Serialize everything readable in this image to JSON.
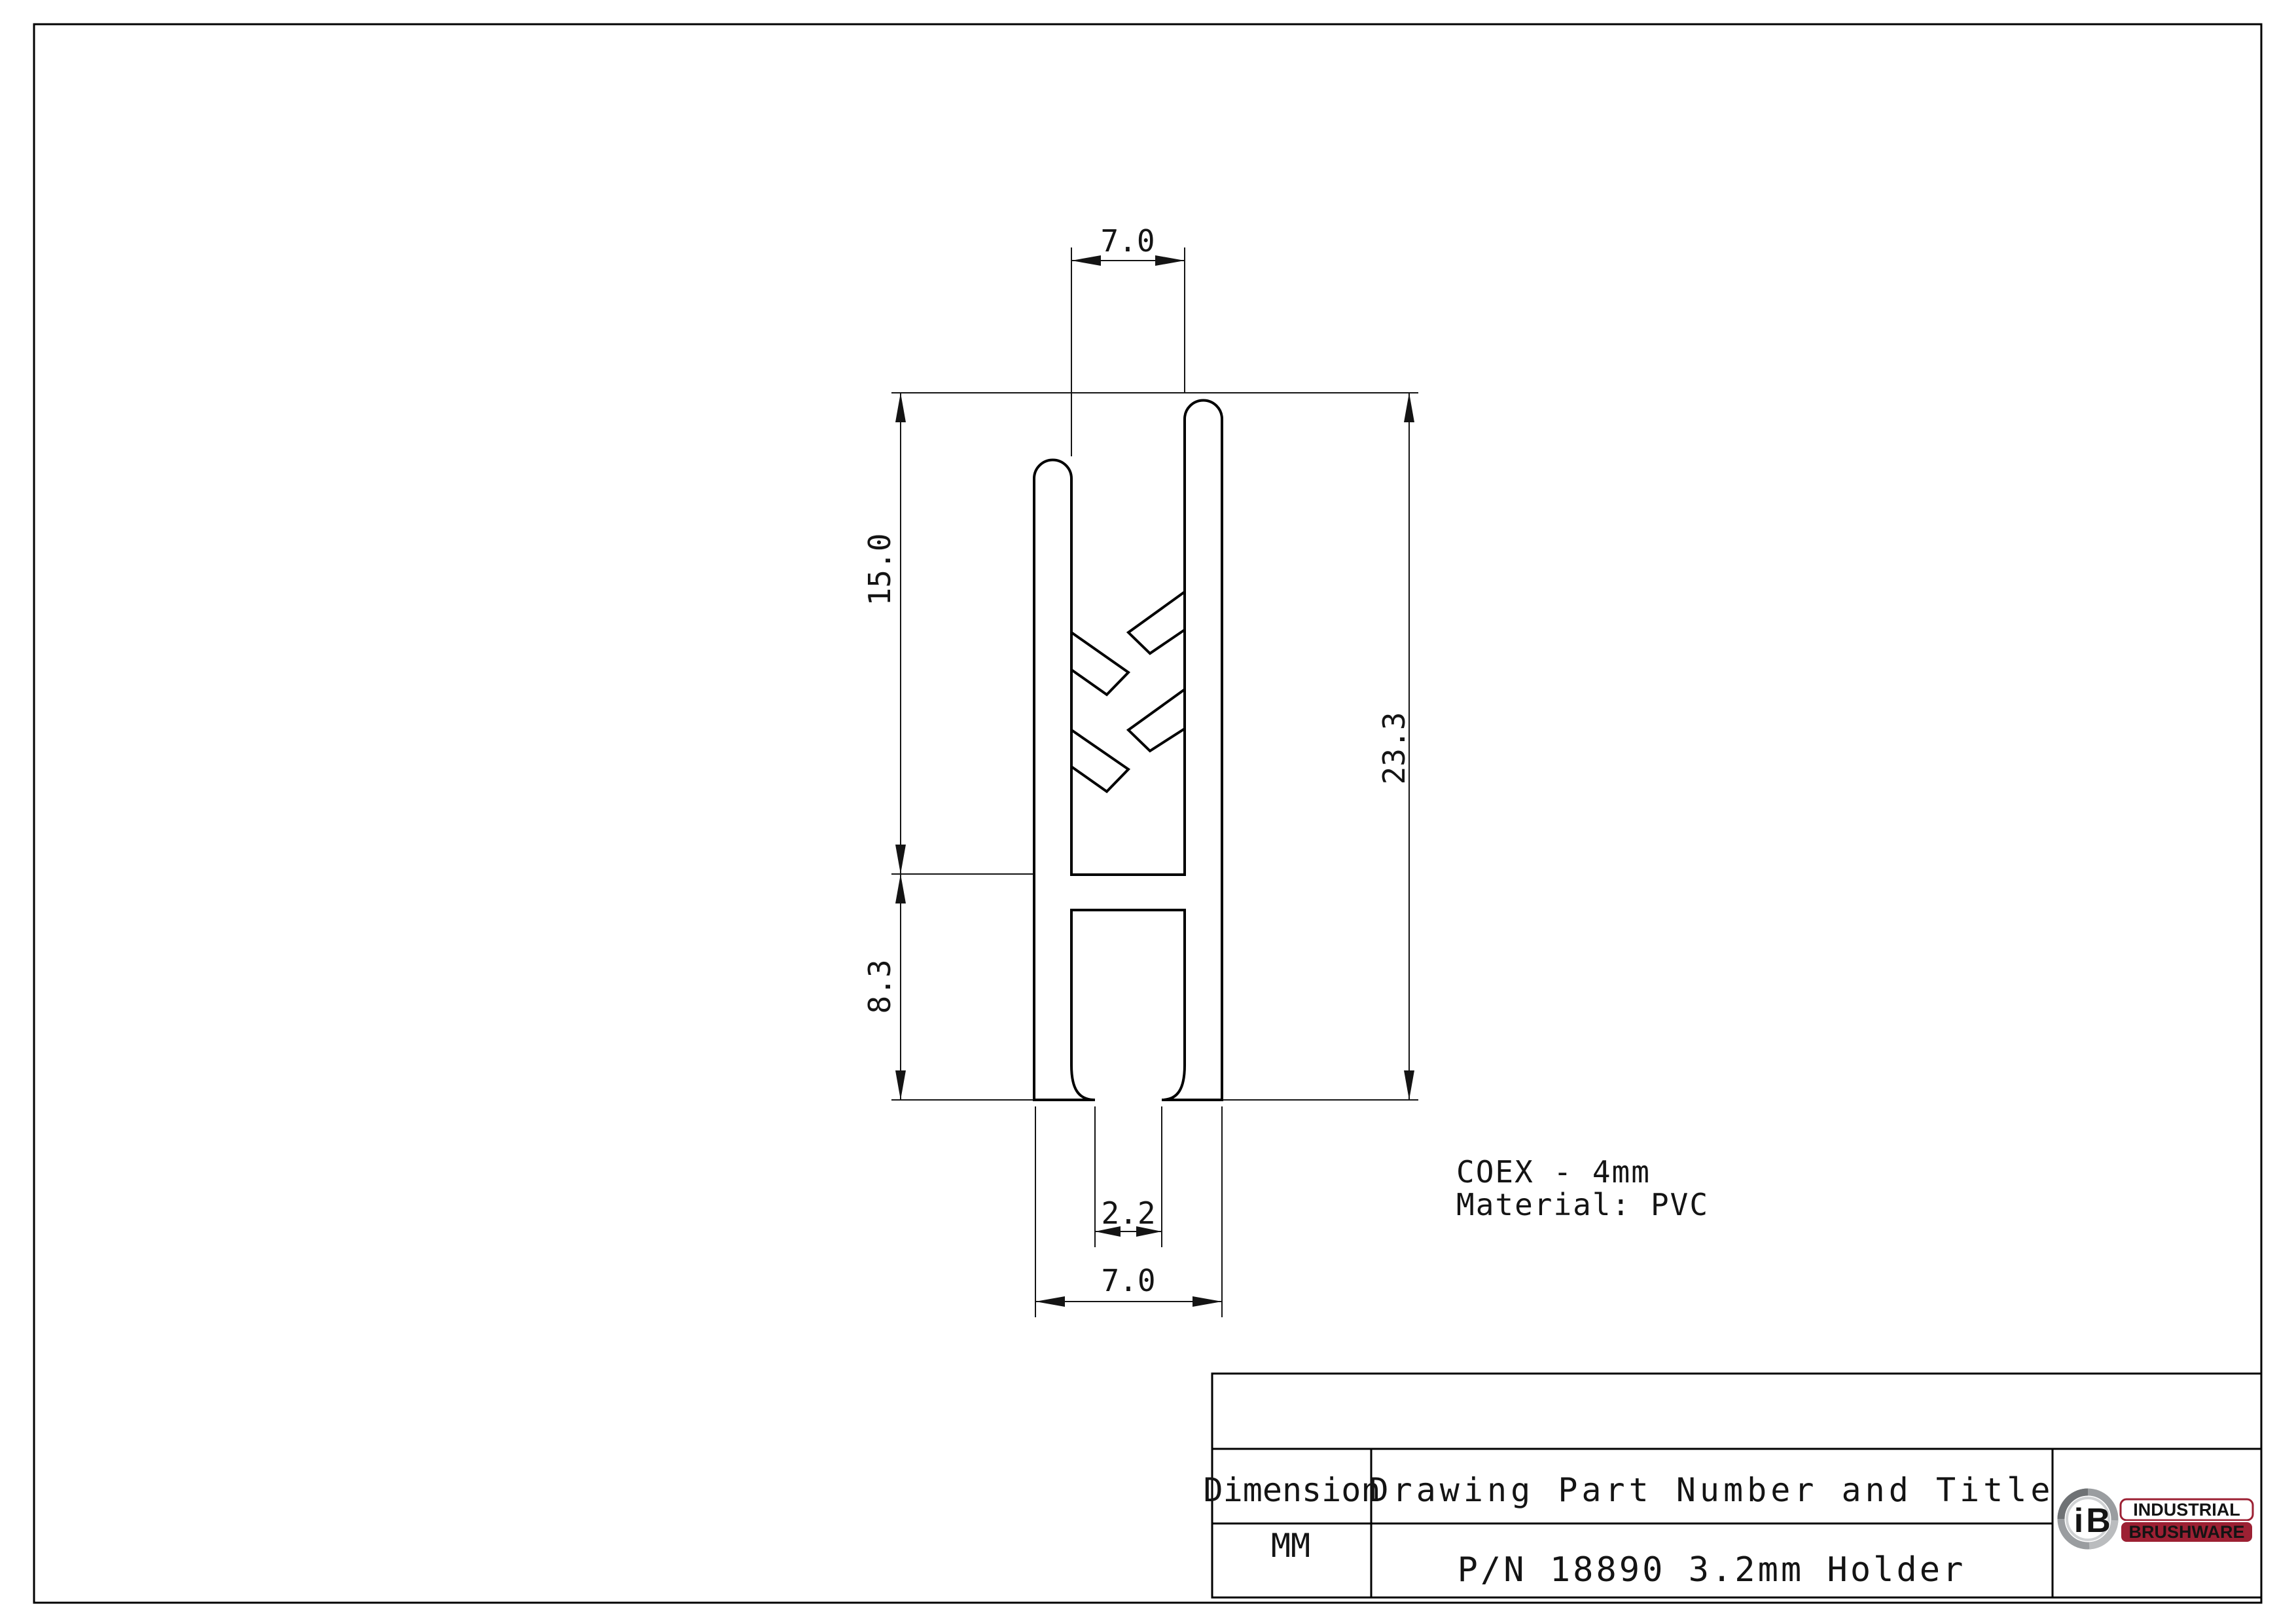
{
  "drawing": {
    "dims": {
      "top_width": "7.0",
      "upper_height": "15.0",
      "lower_height": "8.3",
      "total_height": "23.3",
      "slot_width": "2.2",
      "bottom_width": "7.0"
    },
    "notes": {
      "line1": "COEX - 4mm",
      "line2": "Material: PVC"
    }
  },
  "title_block": {
    "dimension_header": "Dimension",
    "dimension_unit": "MM",
    "title_header": "Drawing Part Number and Title",
    "part_title": "P/N 18890 3.2mm Holder"
  },
  "logo": {
    "monogram_i": "i",
    "monogram_b": "B",
    "word1": "INDUSTRIAL",
    "word2": "BRUSHWARE"
  },
  "colors": {
    "ink": "#141414",
    "accent": "#9c2033",
    "logo_gray": "#9a9da0"
  }
}
